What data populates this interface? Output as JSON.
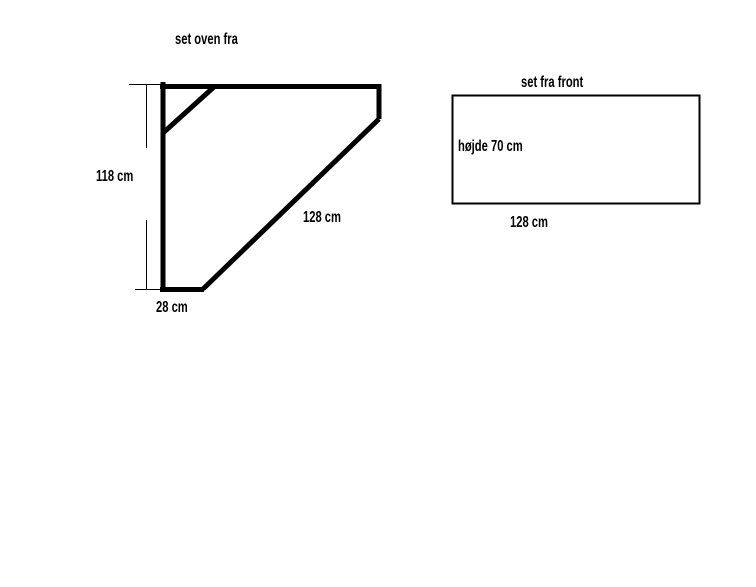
{
  "colors": {
    "ink": "#000000",
    "background": "#ffffff"
  },
  "top_view": {
    "title": "set oven fra",
    "height_label": "118 cm",
    "diagonal_label": "128 cm",
    "depth_label": "28 cm"
  },
  "front_view": {
    "title": "set fra front",
    "height_label": "højde 70 cm",
    "width_label": "128 cm"
  }
}
